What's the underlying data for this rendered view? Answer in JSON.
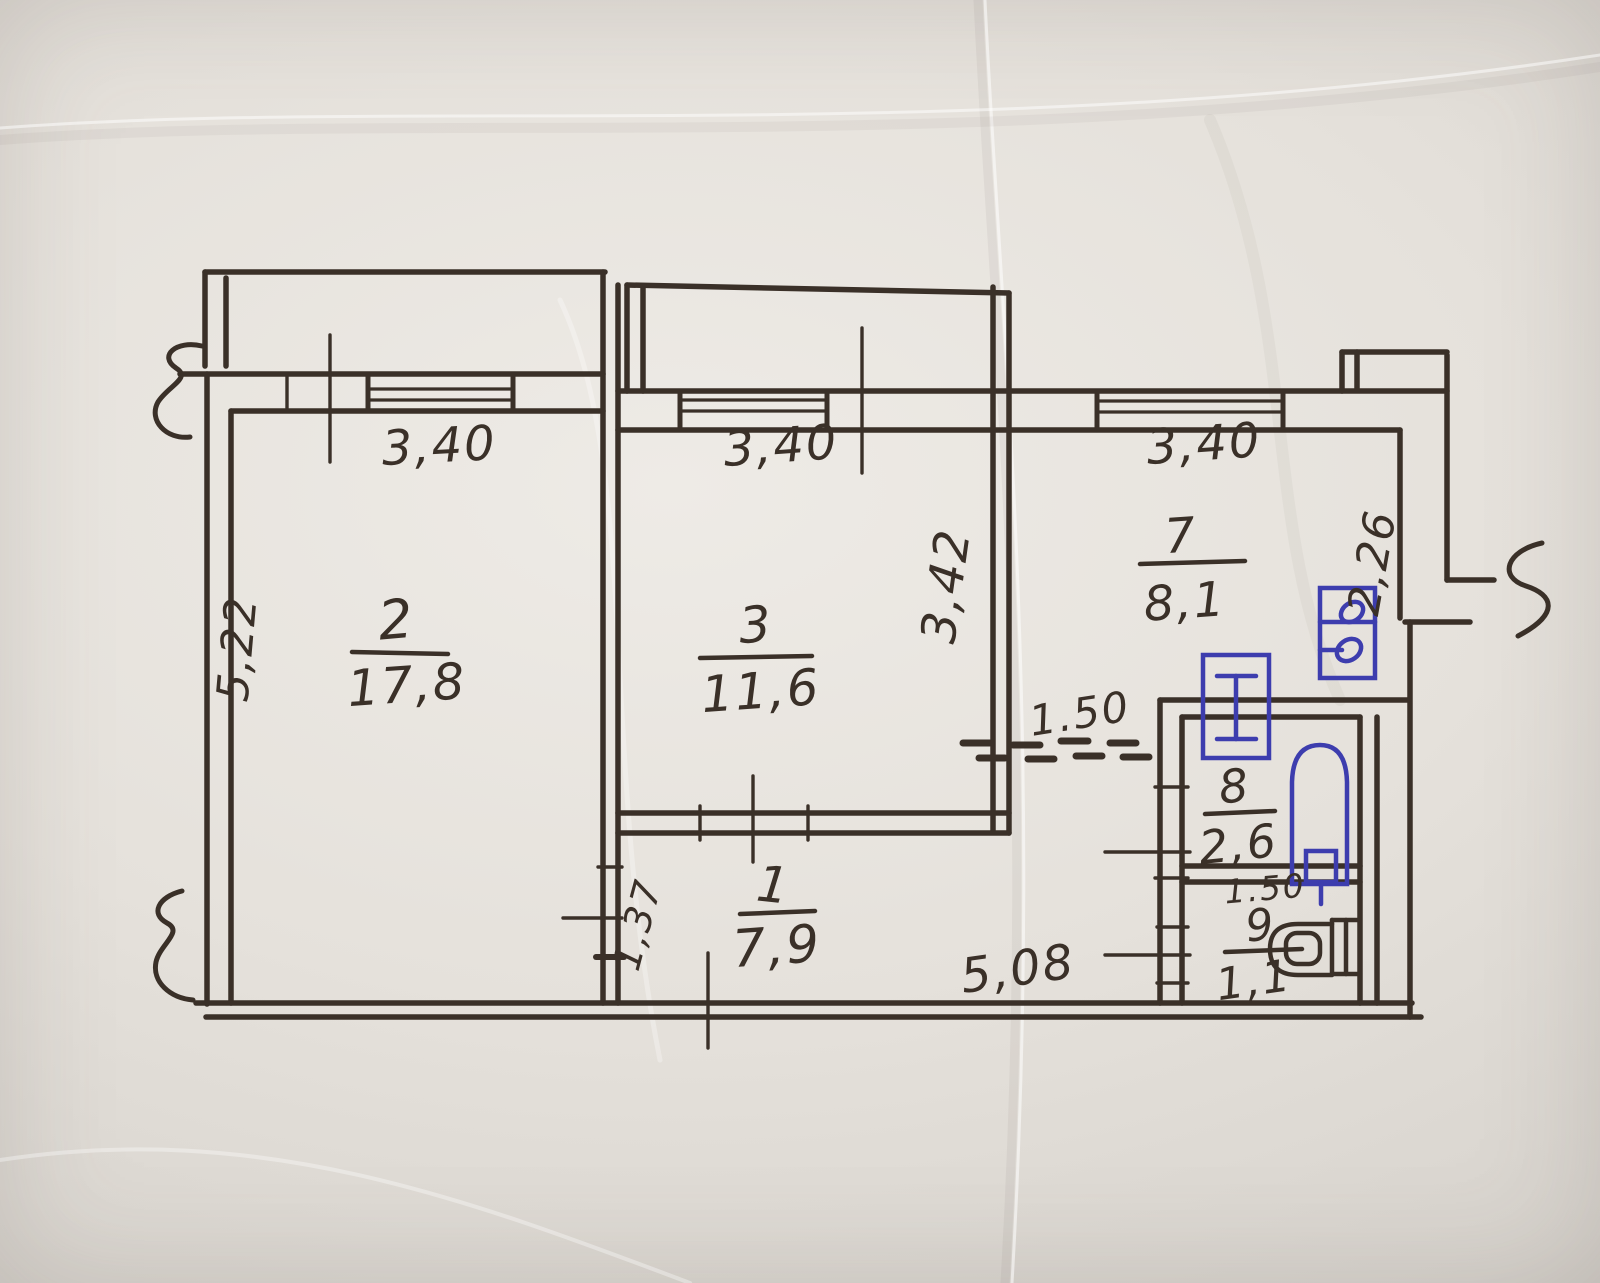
{
  "plan": {
    "rooms": [
      {
        "id": "living-room",
        "number": "2",
        "area": "17,8"
      },
      {
        "id": "bedroom",
        "number": "3",
        "area": "11,6"
      },
      {
        "id": "kitchen",
        "number": "7",
        "area": "8,1"
      },
      {
        "id": "bathroom",
        "number": "8",
        "area": "2,6"
      },
      {
        "id": "toilet",
        "number": "9",
        "area": "1,1"
      },
      {
        "id": "hallway",
        "number": "1",
        "area": "7,9"
      }
    ],
    "dimensions": {
      "room2_top_width": "3,40",
      "room3_top_width": "3,40",
      "kitchen_top_width": "3,40",
      "room2_left_height": "5,22",
      "room3_right_height": "3,42",
      "kitchen_right_height": "2,26",
      "passage_width": "1.50",
      "bathroom_width": "1.50",
      "hallway_height": "1,37",
      "bottom_width": "5,08"
    },
    "colors": {
      "ink": "#3a3028",
      "fixture_ink": "#3d3dae",
      "paper": "#e5e1db"
    }
  }
}
